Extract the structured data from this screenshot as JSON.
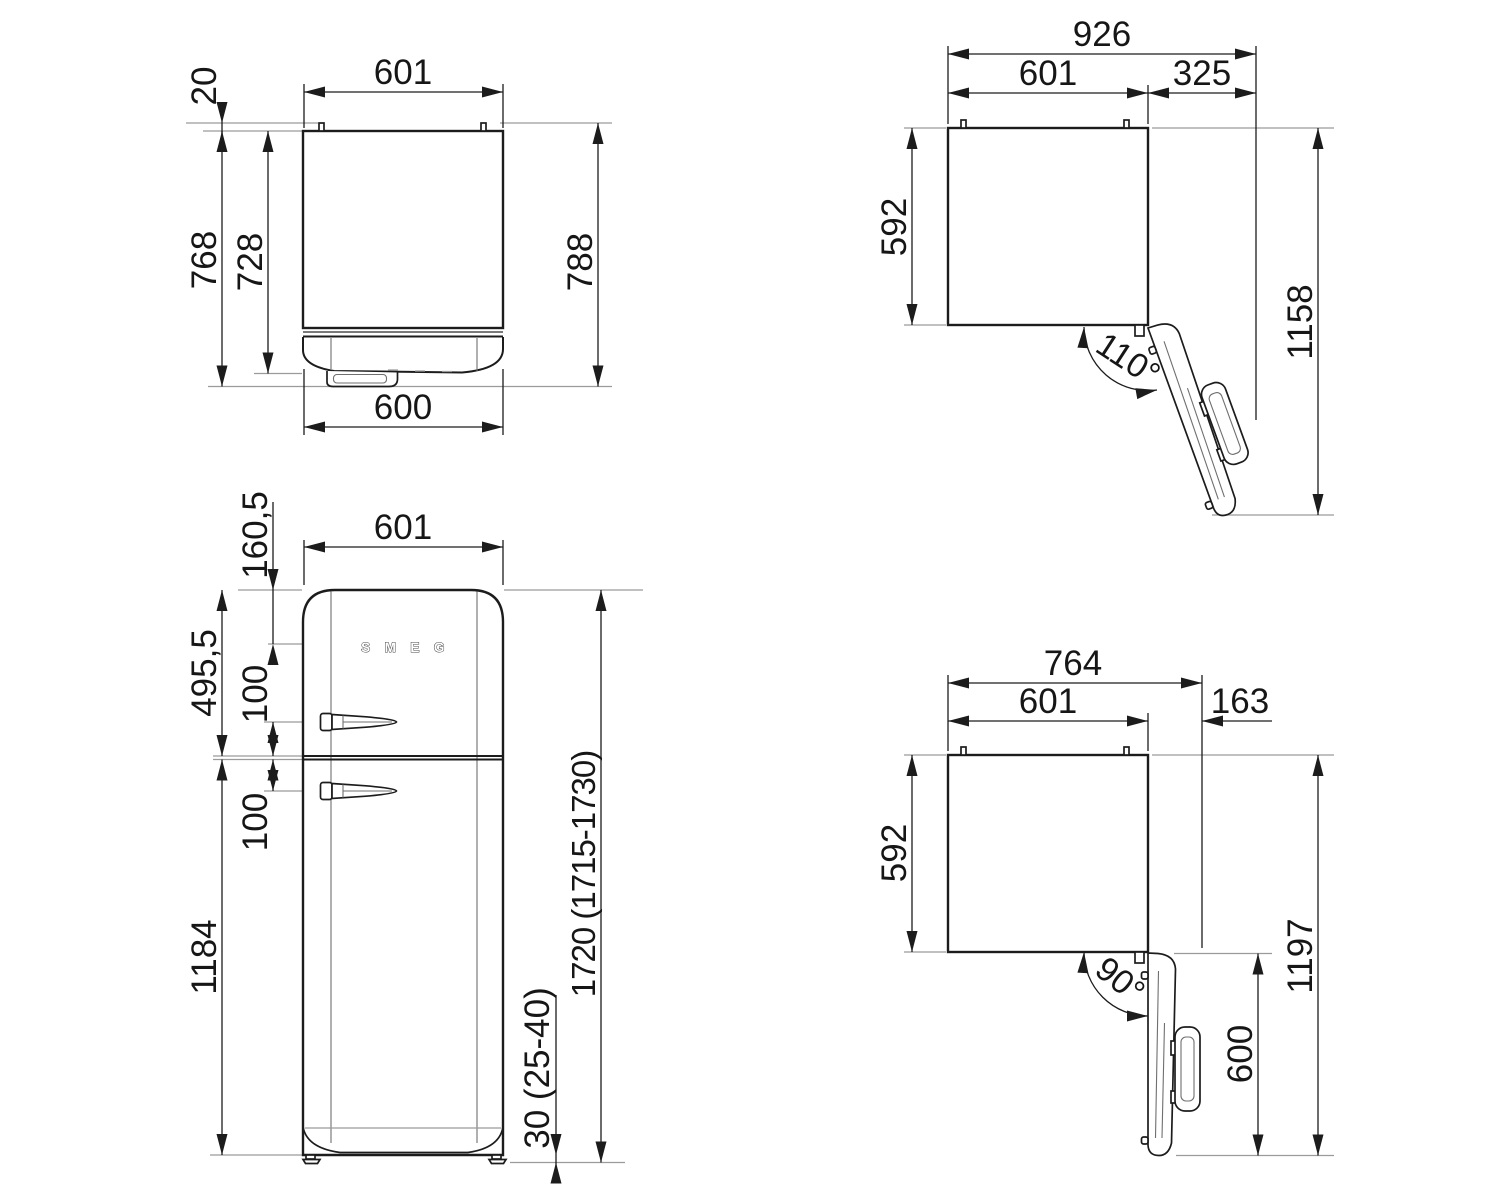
{
  "drawing": {
    "kind": "technical dimension drawing",
    "subject": "retro refrigerator installation dimensions, four orthographic views",
    "units": "mm",
    "line_color": "#1c1c1c",
    "ref_line_color": "#9b9b9b",
    "background": "#ffffff"
  },
  "logo": {
    "text": "SMEG"
  },
  "views": {
    "top_closed": {
      "name": "top view, door closed",
      "width": "601",
      "pin_height": "20",
      "depth_with_handle": "768",
      "depth_without_handle": "728",
      "depth_overall": "788",
      "door_width": "600"
    },
    "door_110": {
      "name": "top view, door open 110 degrees",
      "overall_width": "926",
      "body_width": "601",
      "door_projection": "325",
      "body_depth": "592",
      "overall_depth": "1158",
      "opening_angle": "110°"
    },
    "front": {
      "name": "front view",
      "body_width": "601",
      "top_to_logo": "160,5",
      "upper_section": "495,5",
      "upper_handle_offset": "100",
      "lower_handle_offset": "100",
      "lower_section": "1184",
      "overall_height": "1720 (1715-1730)",
      "feet_height": "30 (25-40)"
    },
    "door_90": {
      "name": "top view, door open 90 degrees",
      "overall_width": "764",
      "body_width": "601",
      "door_projection": "163",
      "body_depth": "592",
      "overall_depth": "1197",
      "door_width": "600",
      "opening_angle": "90°"
    }
  }
}
